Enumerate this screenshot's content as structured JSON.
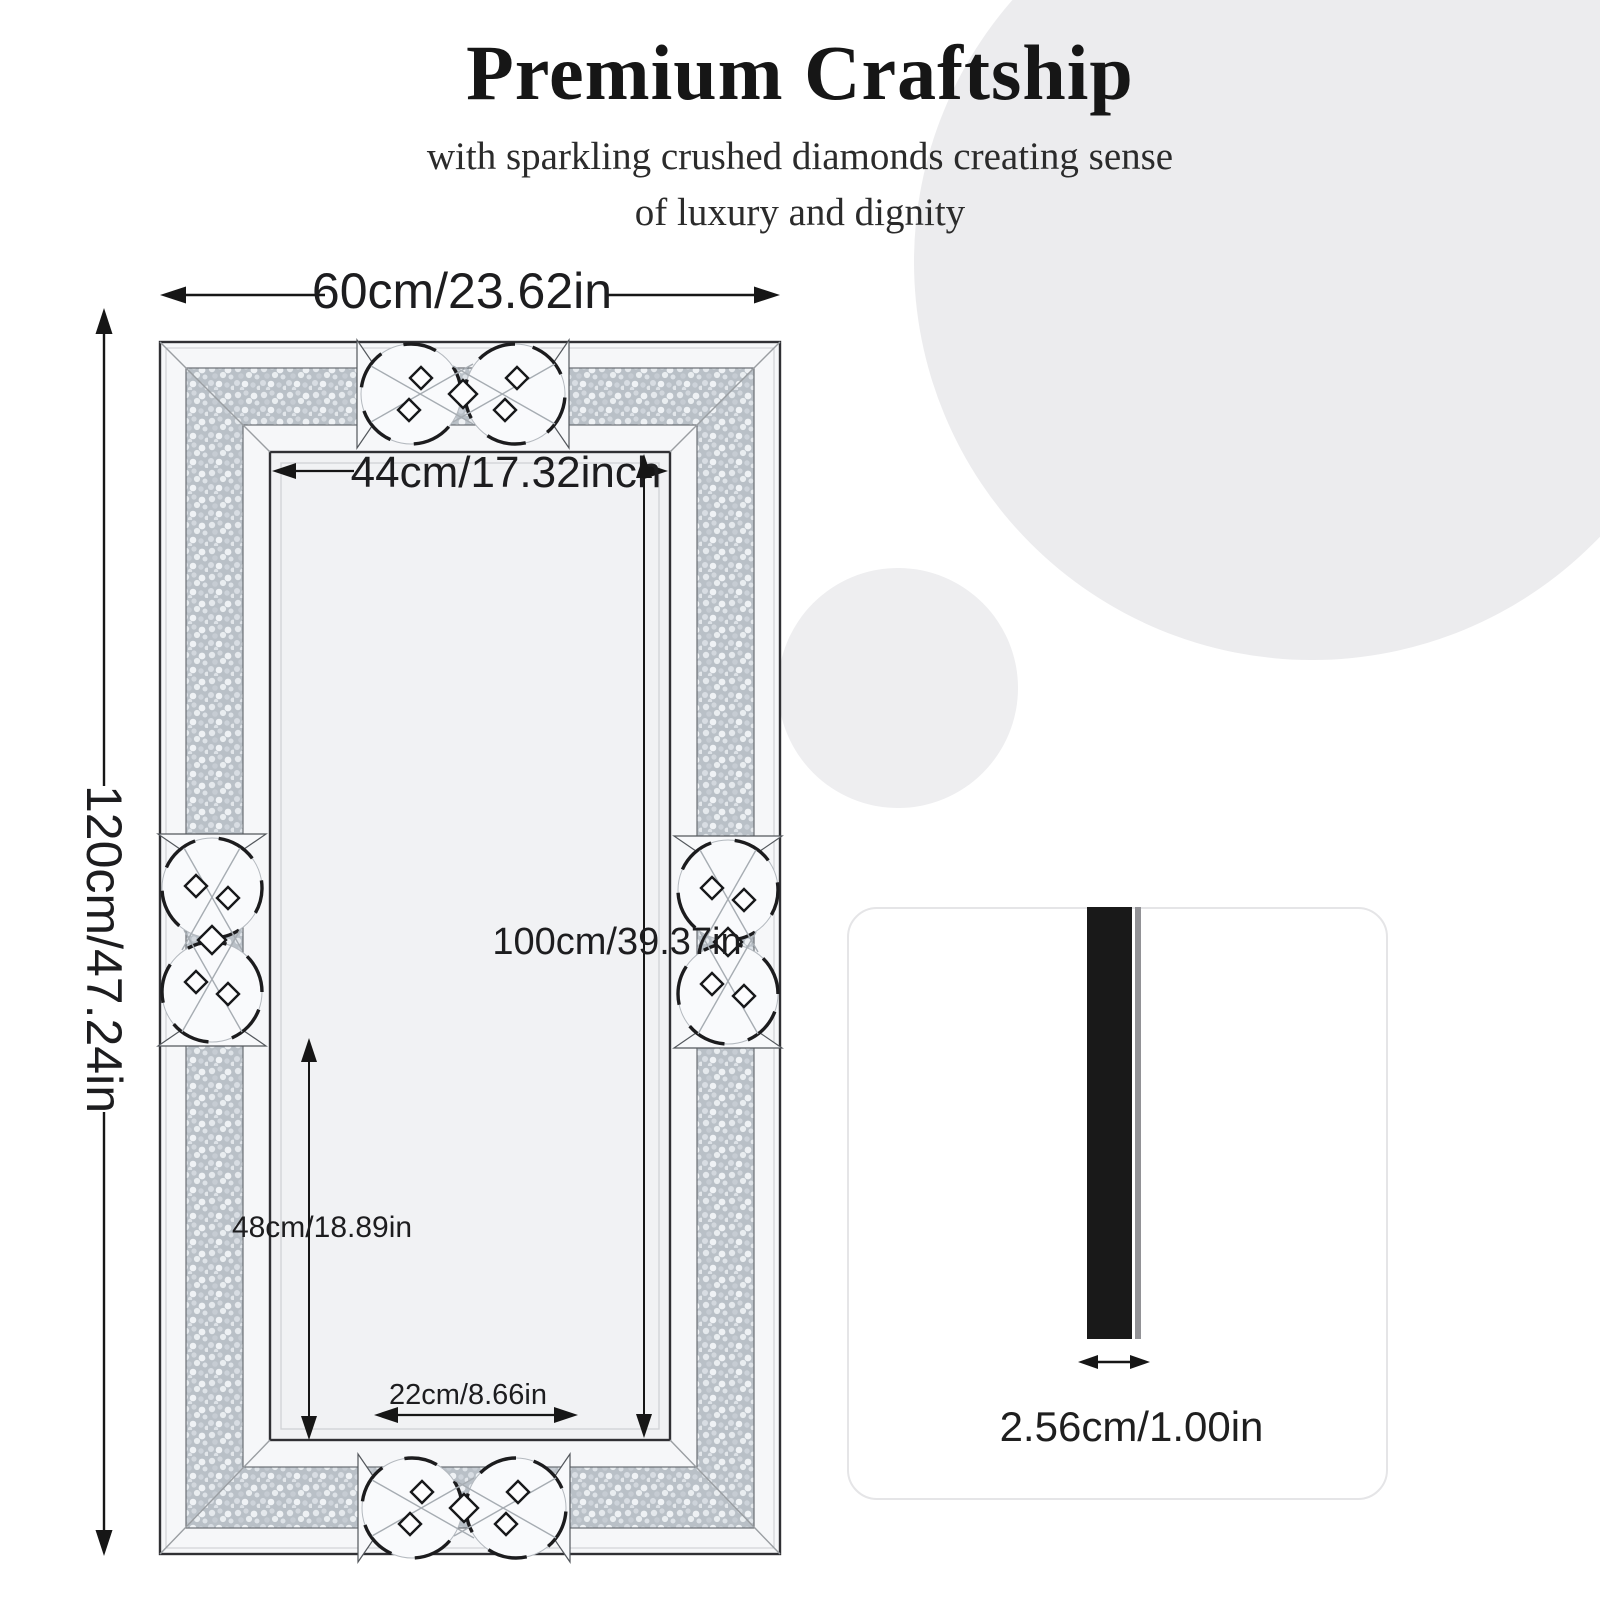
{
  "header": {
    "title": "Premium Craftship",
    "subtitle_line1": "with sparkling crushed diamonds creating sense",
    "subtitle_line2": "of luxury and dignity"
  },
  "diagram": {
    "labels": {
      "outer_width": "60cm/23.62in",
      "outer_height": "120cm/47.24in",
      "inner_width": "44cm/17.32inch",
      "inner_height": "100cm/39.37in",
      "lower_inner_height": "48cm/18.89in",
      "bottom_inner_width": "22cm/8.66in"
    }
  },
  "side_view": {
    "thickness_label": "2.56cm/1.00in"
  },
  "colors": {
    "background_circle": "#ececee",
    "crushed_diamond_base": "#b9c0c7",
    "frame_mirror_strip": "#f6f7f9",
    "dimension_line": "#161616",
    "side_bar": "#191919"
  }
}
